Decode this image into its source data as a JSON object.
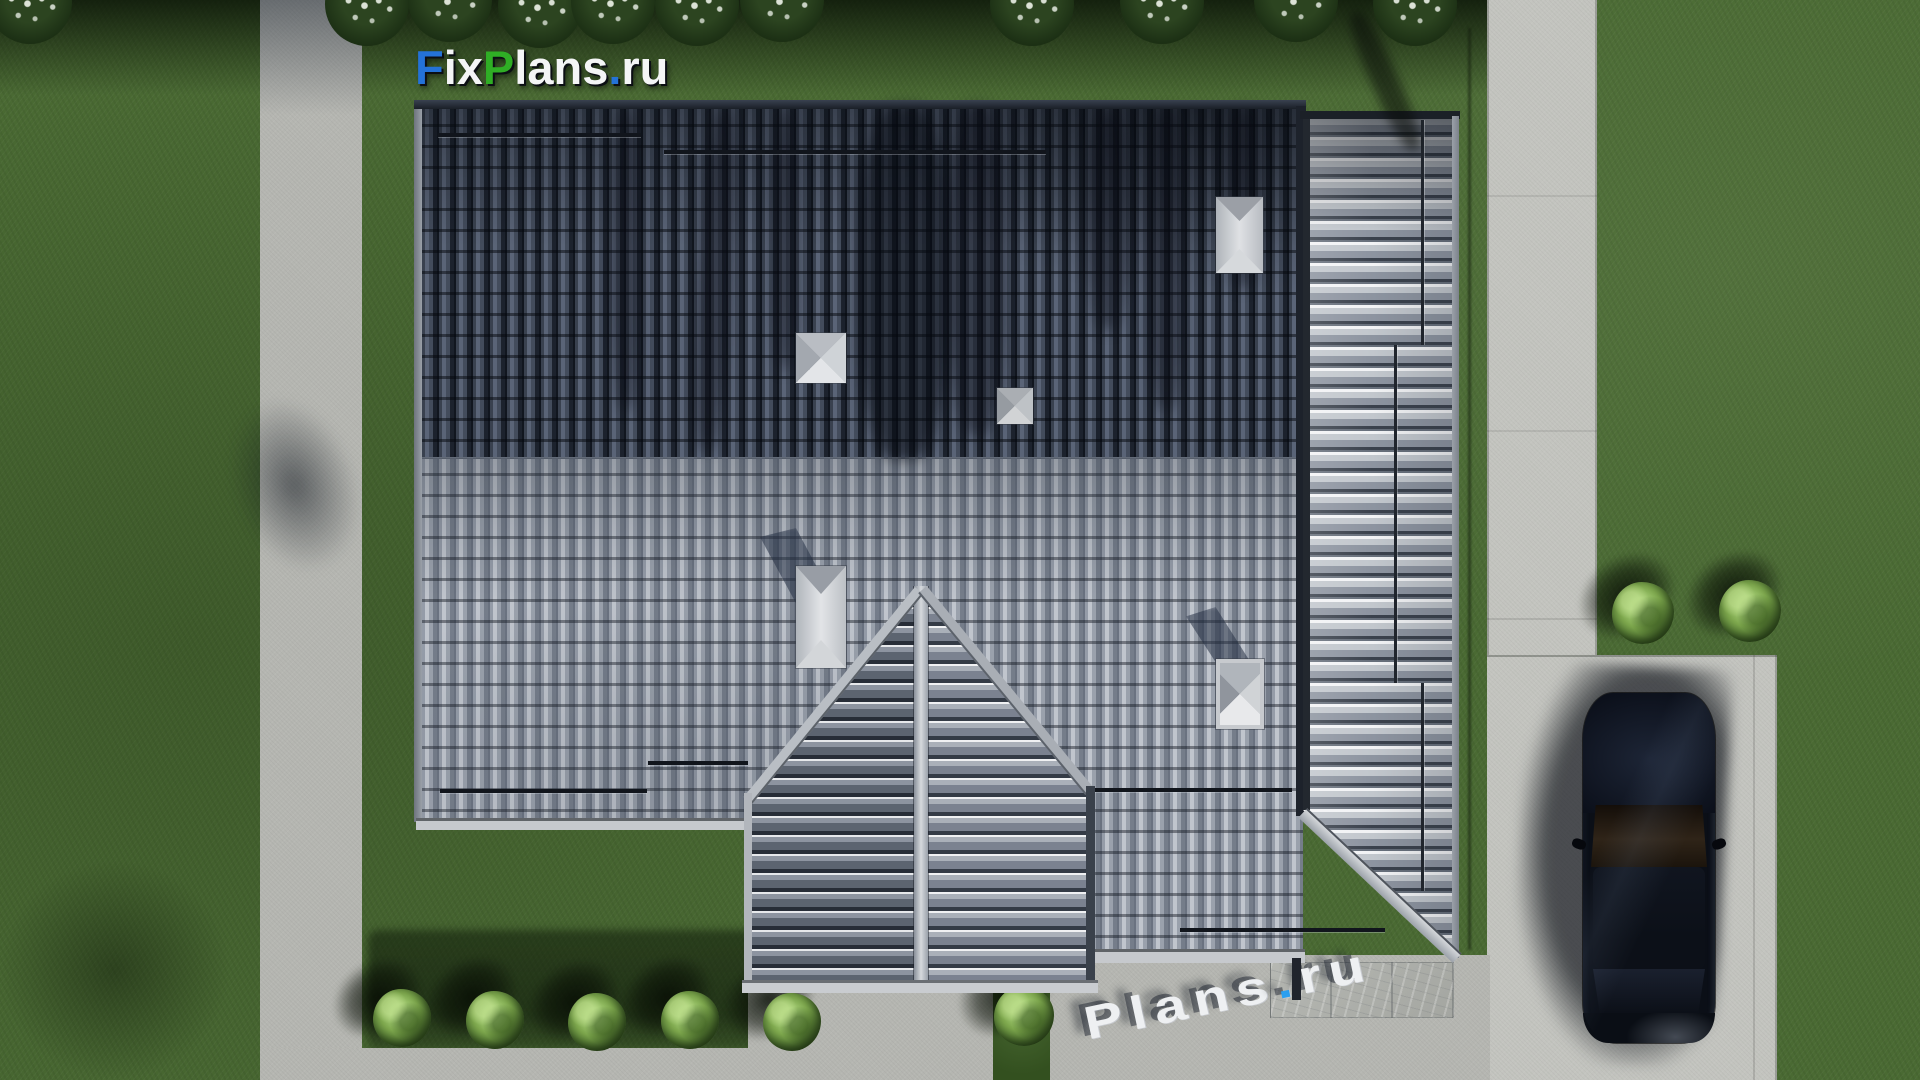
{
  "branding": {
    "top_logo": {
      "fix_f": "F",
      "fix_ix": "ix",
      "plans_p": "P",
      "plans_rest": "lans",
      "dot": ".",
      "tld": "ru"
    },
    "ground_watermark": {
      "name": "Plans",
      "dot": ".",
      "tld": "ru"
    }
  },
  "palette": {
    "grass": "#4a6a33",
    "grass_shadow": "#16260e",
    "concrete": "#b5b6b1",
    "driveway": "#c3c4bf",
    "roof_dark": "#333b49",
    "roof_light": "#9aa1ac",
    "roof_wing": "#c2c7cd",
    "gable_left": "#5c6470",
    "gable_right": "#7b8290",
    "ridge": "#2a313d",
    "chimney": "#cfd3d7",
    "stone": "#b0b2ad",
    "car_body": "#0d1119",
    "logo_blue": "#2472d8",
    "logo_green": "#2fae25",
    "logo_white": "#f4f5f6",
    "watermark_dot_blue": "#2b9ff0"
  }
}
